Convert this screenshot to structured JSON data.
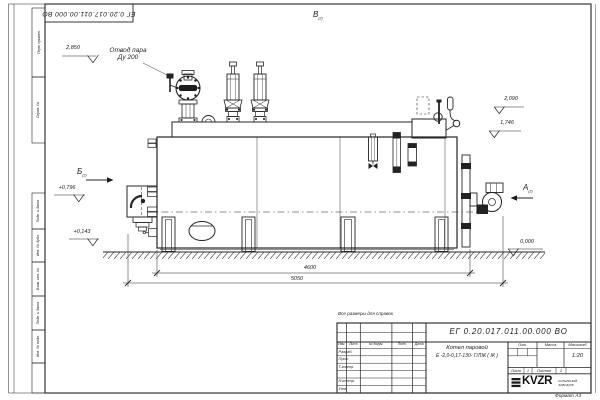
{
  "sheet": {
    "doc_number": "ЕГ 0.20.017.011.00.000  ВО",
    "reference_note": "Все размеры для справок",
    "format_label": "Формат А3",
    "margin_boxes": [
      "Перв. примен.",
      "Справ. №",
      "Подп. и дата",
      "Инв. № дубл.",
      "Взам. инв. №",
      "Подп. и дата",
      "Инв. № подл."
    ]
  },
  "annotations": {
    "steam_outlet": {
      "line1": "Отвод пара",
      "line2": "Ду 200"
    },
    "views": {
      "top": "В",
      "left": "Б",
      "right": "А",
      "sheet_ref": "(2)"
    },
    "elevations": {
      "steam_valve": "2,850",
      "right_upper": "2,090",
      "right_lower": "1,746",
      "left_upper": "+0,796",
      "left_lower": "+0,143",
      "ground": "0,000"
    },
    "dimensions": {
      "support_span": "4600",
      "overall_length": "5050"
    }
  },
  "title_block": {
    "product_line1": "Котел паровой",
    "product_line2": "Е -2,0-0,17-130- Г/ЛЖ ( Ж )",
    "scale": "1:20",
    "columns": {
      "izm": "Изм.",
      "list": "Лист",
      "ndok": "№ докум.",
      "podp": "Подп.",
      "data": "Дата"
    },
    "sign_rows": [
      "Разраб.",
      "Пров.",
      "Т.контр.",
      "Н.контр.",
      "Утв."
    ],
    "props": {
      "lit": "Лит.",
      "massa": "Масса",
      "masshtab": "Масштаб"
    },
    "sheet_row": {
      "list_label": "Лист",
      "list_value": "1",
      "listov_label": "Листов",
      "listov_value": "2"
    },
    "logo": {
      "name": "KVZR",
      "tagline1": "КОТЕЛЬНЫЙ",
      "tagline2": "ЗАВОД РФ"
    }
  }
}
